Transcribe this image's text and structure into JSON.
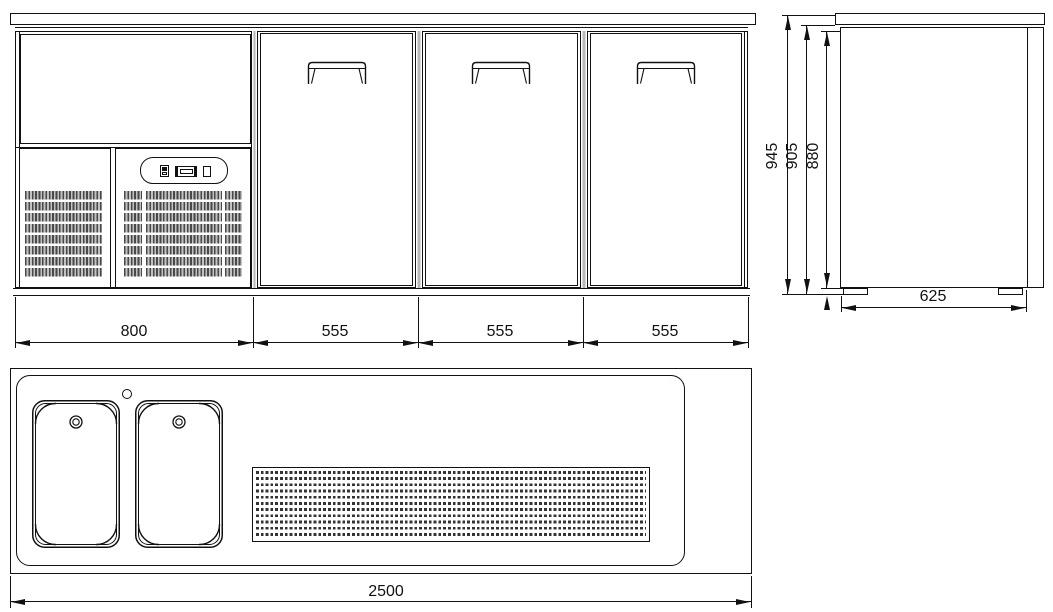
{
  "front_view": {
    "left_section_width": "800",
    "door_widths": [
      "555",
      "555",
      "555"
    ]
  },
  "side_view": {
    "overall_height": "945",
    "mid_height": "905",
    "body_height": "880",
    "depth": "625"
  },
  "plan_view": {
    "overall_length": "2500"
  }
}
